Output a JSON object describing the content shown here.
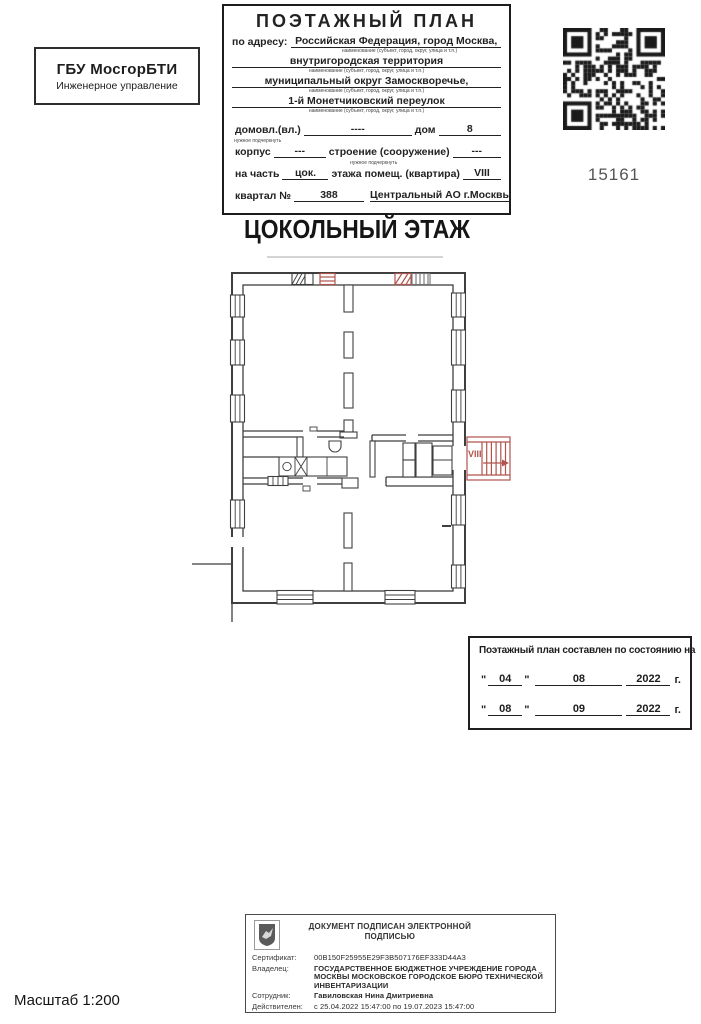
{
  "org_box": {
    "line1": "ГБУ МосгорБТИ",
    "line2": "Инженерное управление"
  },
  "header": {
    "title": "ПОЭТАЖНЫЙ ПЛАН",
    "address_label": "по адресу:",
    "address_lines": [
      "Российская Федерация, город Москва,",
      "внутригородская территория",
      "муниципальный округ Замоскворечье,",
      "1-й Монетчиковский переулок"
    ],
    "address_caption": "наименование (субъект, город, округ, улица и т.п.)",
    "underline_note": "нужное подчеркнуть",
    "fields": {
      "domovl_label": "домовл.(вл.)",
      "domovl_value": "----",
      "dom_label": "дом",
      "dom_value": "8",
      "korpus_label": "корпус",
      "korpus_value": "---",
      "stroenie_label": "строение (сооружение)",
      "stroenie_value": "---",
      "na_chast_label": "на часть",
      "na_chast_value": "цок.",
      "etazha_label": "этажа помещ. (квартира)",
      "etazha_value": "VIII",
      "kvartal_label": "квартал №",
      "kvartal_value": "388",
      "okrug_value": "Центральный АО г.Москвы"
    }
  },
  "qr": {
    "number": "15161"
  },
  "floor_title": "ЦОКОЛЬНЫЙ ЭТАЖ",
  "plan": {
    "stair_label": "VIII"
  },
  "date_box": {
    "title": "Поэтажный план составлен по состоянию на",
    "quote_char": "\"",
    "year_suffix": "г.",
    "rows": [
      {
        "day": "04",
        "month": "08",
        "year": "2022"
      },
      {
        "day": "08",
        "month": "09",
        "year": "2022"
      }
    ]
  },
  "signature": {
    "header_line1": "ДОКУМЕНТ ПОДПИСАН ЭЛЕКТРОННОЙ",
    "header_line2": "ПОДПИСЬЮ",
    "rows": [
      {
        "label": "Сертификат:",
        "value": "00B150F25955E29F3B507176EF333D44A3"
      },
      {
        "label": "Владелец:",
        "value": "ГОСУДАРСТВЕННОЕ БЮДЖЕТНОЕ УЧРЕЖДЕНИЕ ГОРОДА МОСКВЫ МОСКОВСКОЕ ГОРОДСКОЕ БЮРО ТЕХНИЧЕСКОЙ ИНВЕНТАРИЗАЦИИ"
      },
      {
        "label": "Сотрудник:",
        "value": "Гавиловская Нина Дмитриевна"
      },
      {
        "label": "Действителен:",
        "value": "с 25.04.2022 15:47:00 по 19.07.2023 15:47:00"
      }
    ]
  },
  "scale_label": "Масштаб 1:200",
  "colors": {
    "wall": "#3f3f3f",
    "red": "#b0544c",
    "red_light": "#fbf0ee"
  }
}
